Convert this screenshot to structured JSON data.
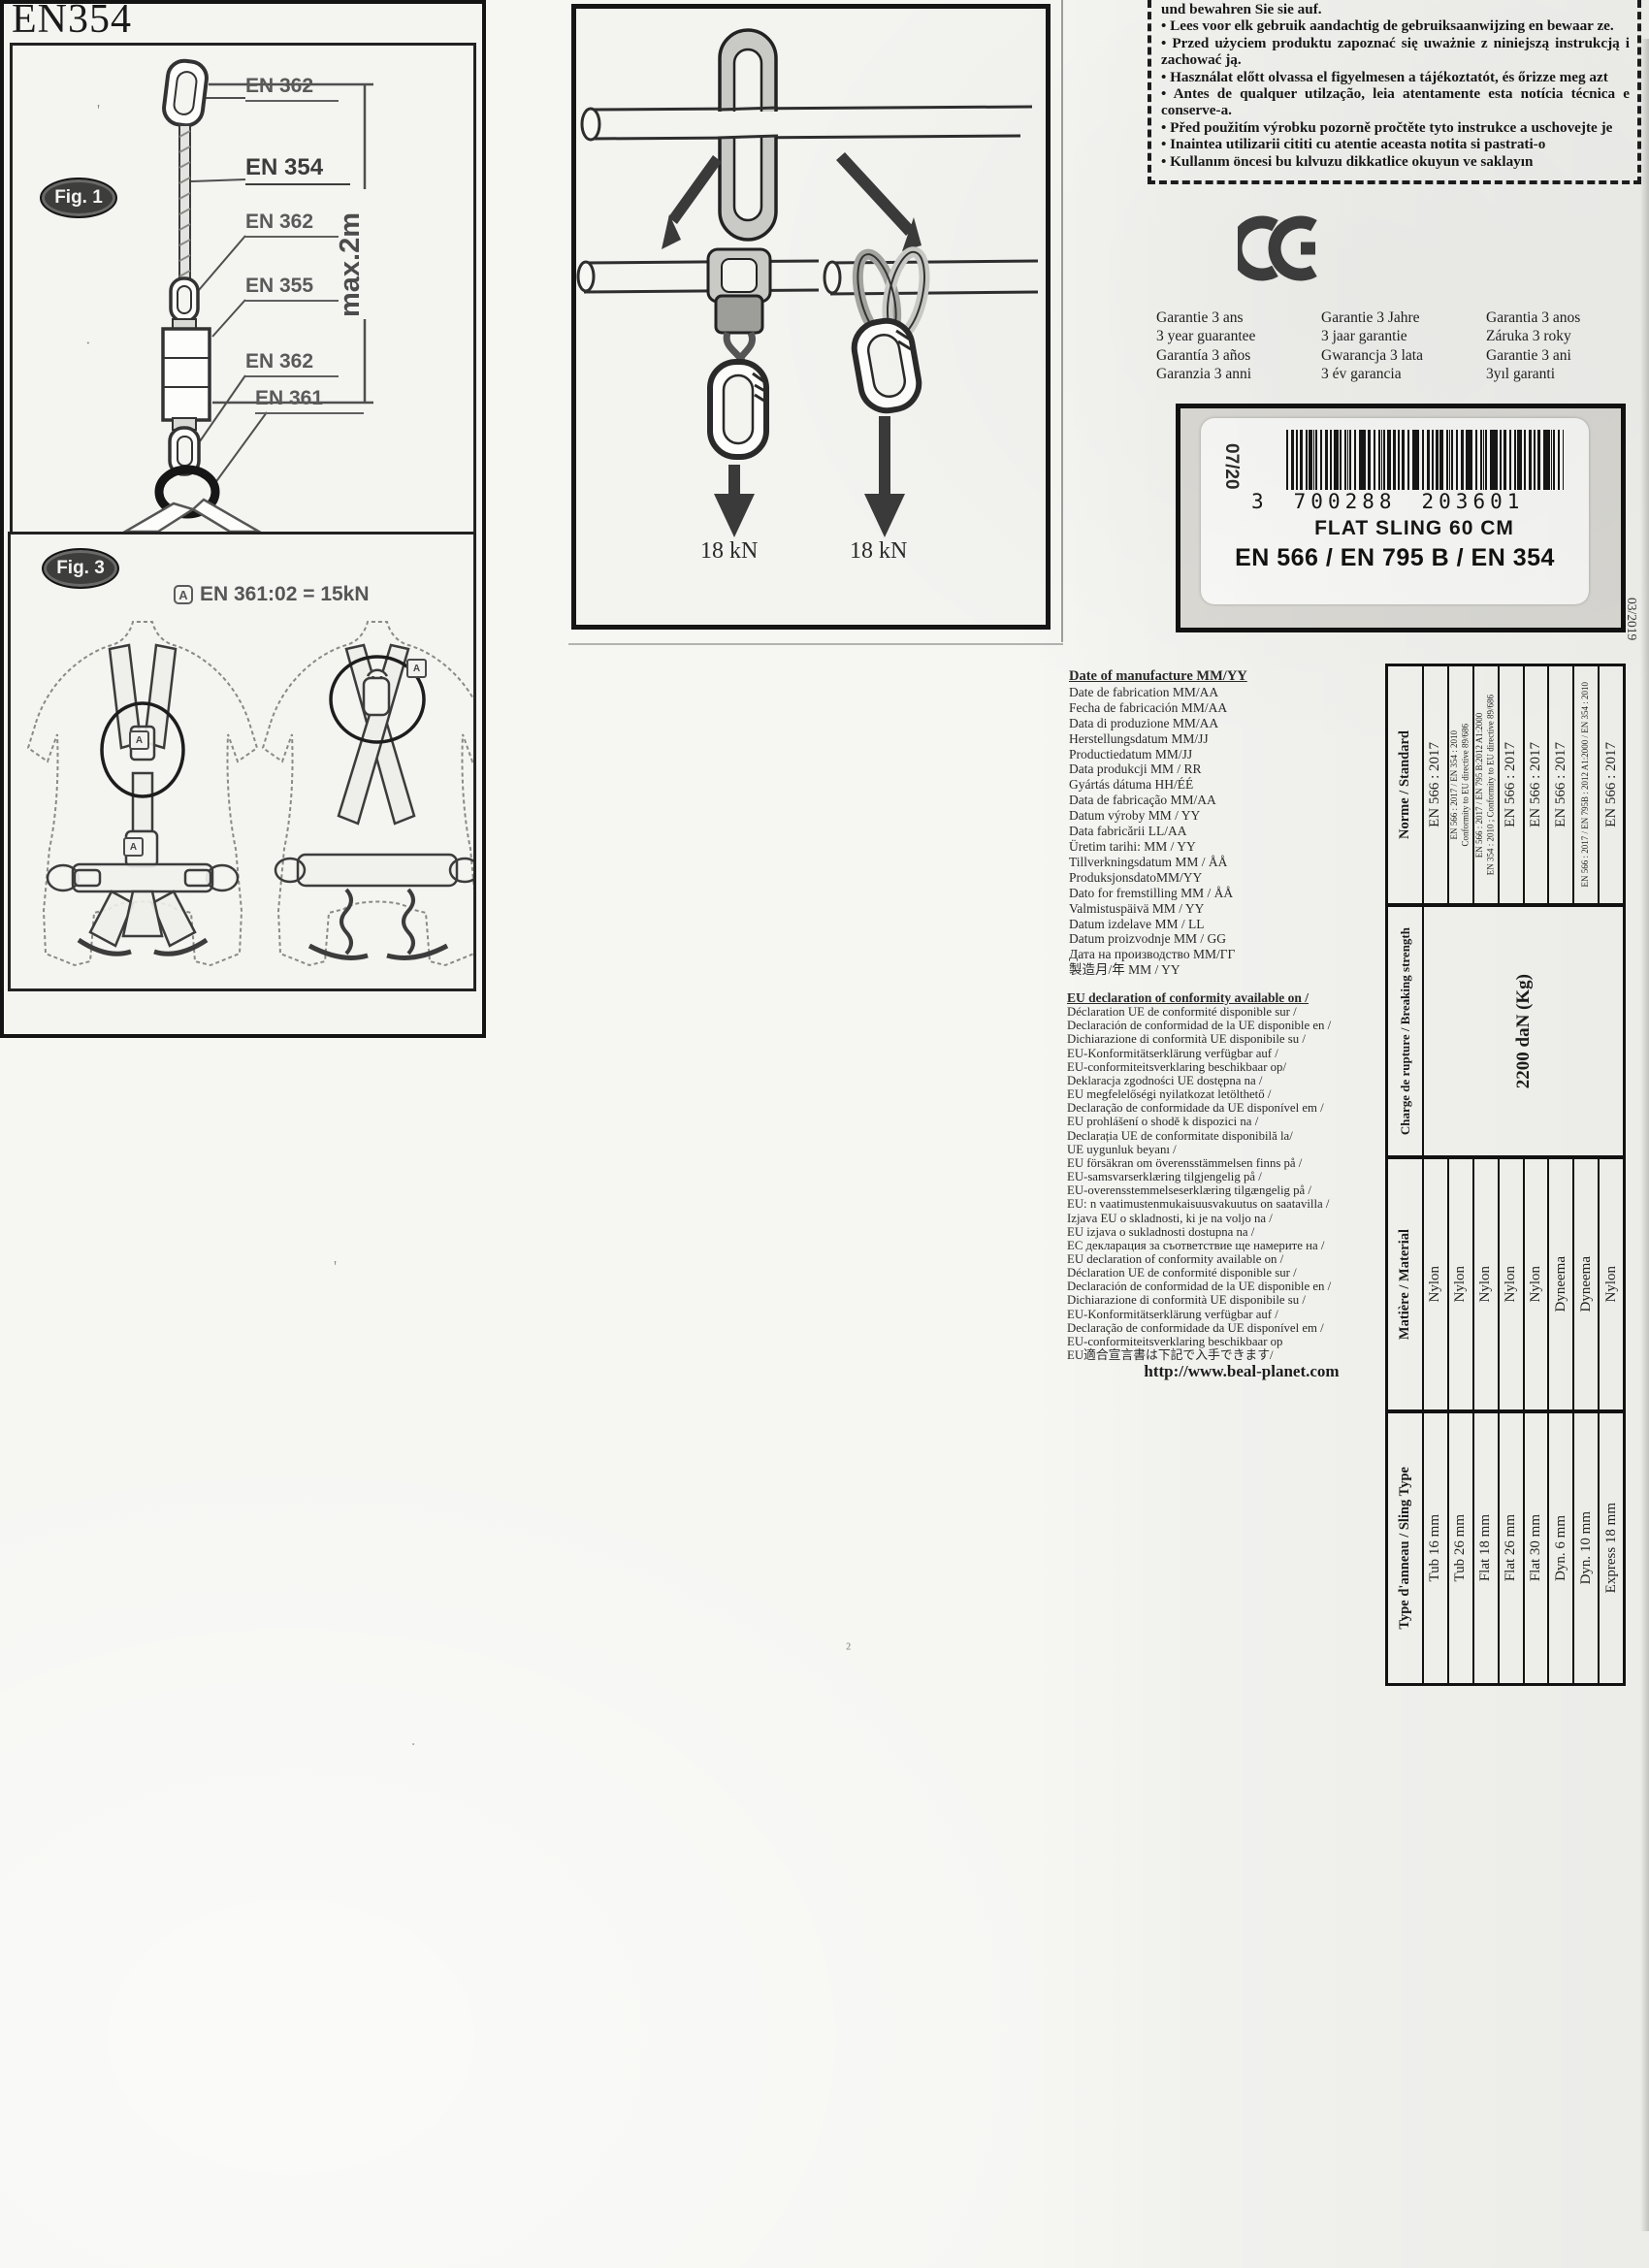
{
  "top_figure": {
    "force_left": "18 kN",
    "force_right": "18 kN"
  },
  "warning_box": {
    "lines": [
      "und bewahren Sie sie auf.",
      "• Lees voor elk gebruik aandachtig de gebruiksaanwijzing en bewaar ze.",
      "• Przed użyciem produktu zapoznać się uważnie z niniejszą instrukcją i zachować ją.",
      "• Használat előtt olvassa el figyelmesen a tájékoztatót, és őrizze meg azt",
      "• Antes de qualquer utilzação, leia atentamente esta notícia técnica e conserve-a.",
      "• Před použitím  výrobku  pozorně pročtěte tyto instrukce a uschovejte je",
      "• Inaintea utilizarii cititi cu atentie aceasta notita si pastrati-o",
      "• Kullanım öncesi bu kılvuzu dikkatlice okuyun ve saklayın"
    ]
  },
  "ce_mark": "CE",
  "guarantee": {
    "col1": "Garantie 3 ans\n3 year guarantee\nGarantía 3 años\nGaranzia 3 anni",
    "col2": "Garantie 3 Jahre\n3 jaar garantie\nGwarancja 3 lata\n3 év garancia",
    "col3": "Garantia 3 anos\nZáruka 3 roky\nGarantie 3 ani\n3yıl garanti"
  },
  "product_label": {
    "date_stamp": "07/20",
    "ean_prefix": "3",
    "ean_group1": "700288",
    "ean_group2": "203601",
    "product_name": "FLAT SLING 60 CM",
    "standards_line": "EN 566 / EN 795 B / EN 354"
  },
  "print_date": "03/2019",
  "en354_section": {
    "title": "EN354",
    "fig1": {
      "caption": "Fig. 1",
      "part_labels": [
        "EN 362",
        "EN 354",
        "EN 362",
        "EN 355",
        "EN 362",
        "EN 361"
      ],
      "max_length": "max.2m"
    },
    "fig3": {
      "caption": "Fig. 3",
      "marker": "A",
      "note": "EN 361:02 = 15kN"
    }
  },
  "manufacture_date": {
    "heading": "Date of manufacture MM/YY",
    "lines": [
      "Date de fabrication MM/AA",
      "Fecha de fabricación MM/AA",
      "Data di produzione  MM/AA",
      "Herstellungsdatum MM/JJ",
      "Productiedatum MM/JJ",
      "Data produkcji MM / RR",
      "Gyártás dátuma HH/ÉÉ",
      "Data de fabricação MM/AA",
      "Datum výroby MM / YY",
      "Data fabricării LL/AA",
      "Üretim tarihi: MM / YY",
      "Tillverkningsdatum MM / ÅÅ",
      "ProduksjonsdatoMM/YY",
      "Dato for fremstilling MM / ÅÅ",
      "Valmistuspäivä MM / YY",
      "Datum izdelave MM / LL",
      "Datum proizvodnje MM / GG",
      "Дата на производство MM/ГГ",
      "製造月/年 MM / YY"
    ]
  },
  "eu_declaration": {
    "heading": "EU declaration of conformity available on /",
    "lines": [
      "Déclaration UE de conformité disponible sur /",
      "Declaración de conformidad de la UE disponible en /",
      "Dichiarazione di conformità UE disponibile su /",
      "EU-Konformitätserklärung verfügbar auf /",
      "EU-conformiteitsverklaring beschikbaar op/",
      "Deklaracja zgodności UE dostępna na /",
      "EU megfelelőségi nyilatkozat letölthető   /",
      "Declaração de conformidade da UE disponível em /",
      "EU prohlášení o shodě k dispozici na /",
      "Declarația UE de conformitate disponibilă la/",
      "UE uygunluk beyanı /",
      "EU försäkran om överensstämmelsen finns på /",
      "EU-samsvarserklæring tilgjengelig på /",
      "EU-overensstemmelseserklæring tilgængelig på /",
      "EU: n vaatimustenmukaisuusvakuutus on saatavilla /",
      "Izjava EU o skladnosti, ki je na voljo na /",
      "EU izjava o sukladnosti dostupna na /",
      "ЕС декларация за съответствие ще намерите на /",
      "EU declaration of conformity available on /",
      "Déclaration UE de conformité disponible sur /",
      "Declaración de conformidad de la UE disponible en /",
      "Dichiarazione di conformità UE disponibile su /",
      "EU-Konformitätserklärung verfügbar auf /",
      "Declaração de conformidade da UE disponível em /",
      "EU-conformiteitsverklaring beschikbaar op",
      "EU適合宣言書は下記で入手できます/"
    ],
    "url": "http://www.beal-planet.com"
  },
  "spec_table": {
    "headers": [
      "Norme / Standard",
      "Charge de rupture / Breaking strength",
      "Matière / Material",
      "Type d'anneau / Sling Type"
    ],
    "standards": [
      "EN 566 : 2017",
      "EN 566 : 2017 / EN 354 : 2010\nConformity to EU directive 89/686",
      "EN 566 : 2017 / EN 795 B:2012 A1:2000\nEN 354 : 2010 ; Conformity to EU directive 89/686",
      "EN 566 : 2017",
      "EN 566 : 2017",
      "EN 566 : 2017",
      "EN 566 : 2017 / EN 795B : 2012 A1:2000 / EN 354 : 2010",
      "EN 566 : 2017"
    ],
    "breaking_strength": "2200 daN (Kg)",
    "materials": [
      "Nylon",
      "Nylon",
      "Nylon",
      "Nylon",
      "Nylon",
      "Dyneema",
      "Dyneema",
      "Nylon"
    ],
    "sling_types": [
      "Tub 16 mm",
      "Tub 26 mm",
      "Flat 18 mm",
      "Flat 26 mm",
      "Flat 30 mm",
      "Dyn. 6 mm",
      "Dyn. 10 mm",
      "Express 18 mm"
    ]
  }
}
